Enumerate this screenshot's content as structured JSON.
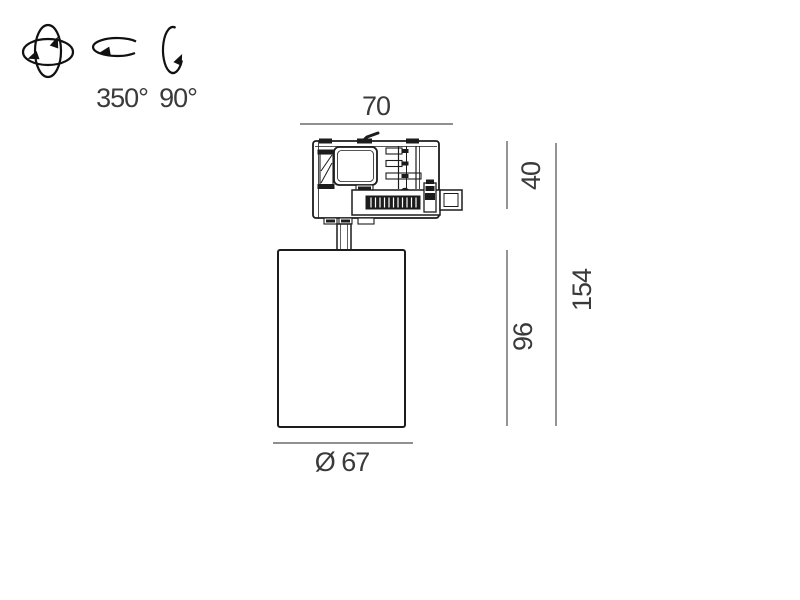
{
  "colors": {
    "background": "#ffffff",
    "drawing_line": "#1c1c1c",
    "dimension_line": "#4d4d4d",
    "dimension_text": "#3a3a3a"
  },
  "rotation_info": {
    "icons": [
      {
        "name": "gimbal-rotation-icon"
      },
      {
        "name": "pan-rotation-icon"
      },
      {
        "name": "tilt-rotation-icon"
      }
    ],
    "pan_range_label": "350°",
    "tilt_range_label": "90°"
  },
  "dimensions": {
    "adapter_width": "70",
    "adapter_height": "40",
    "body_height": "96",
    "total_height": "154",
    "body_diameter": "Ø 67"
  }
}
